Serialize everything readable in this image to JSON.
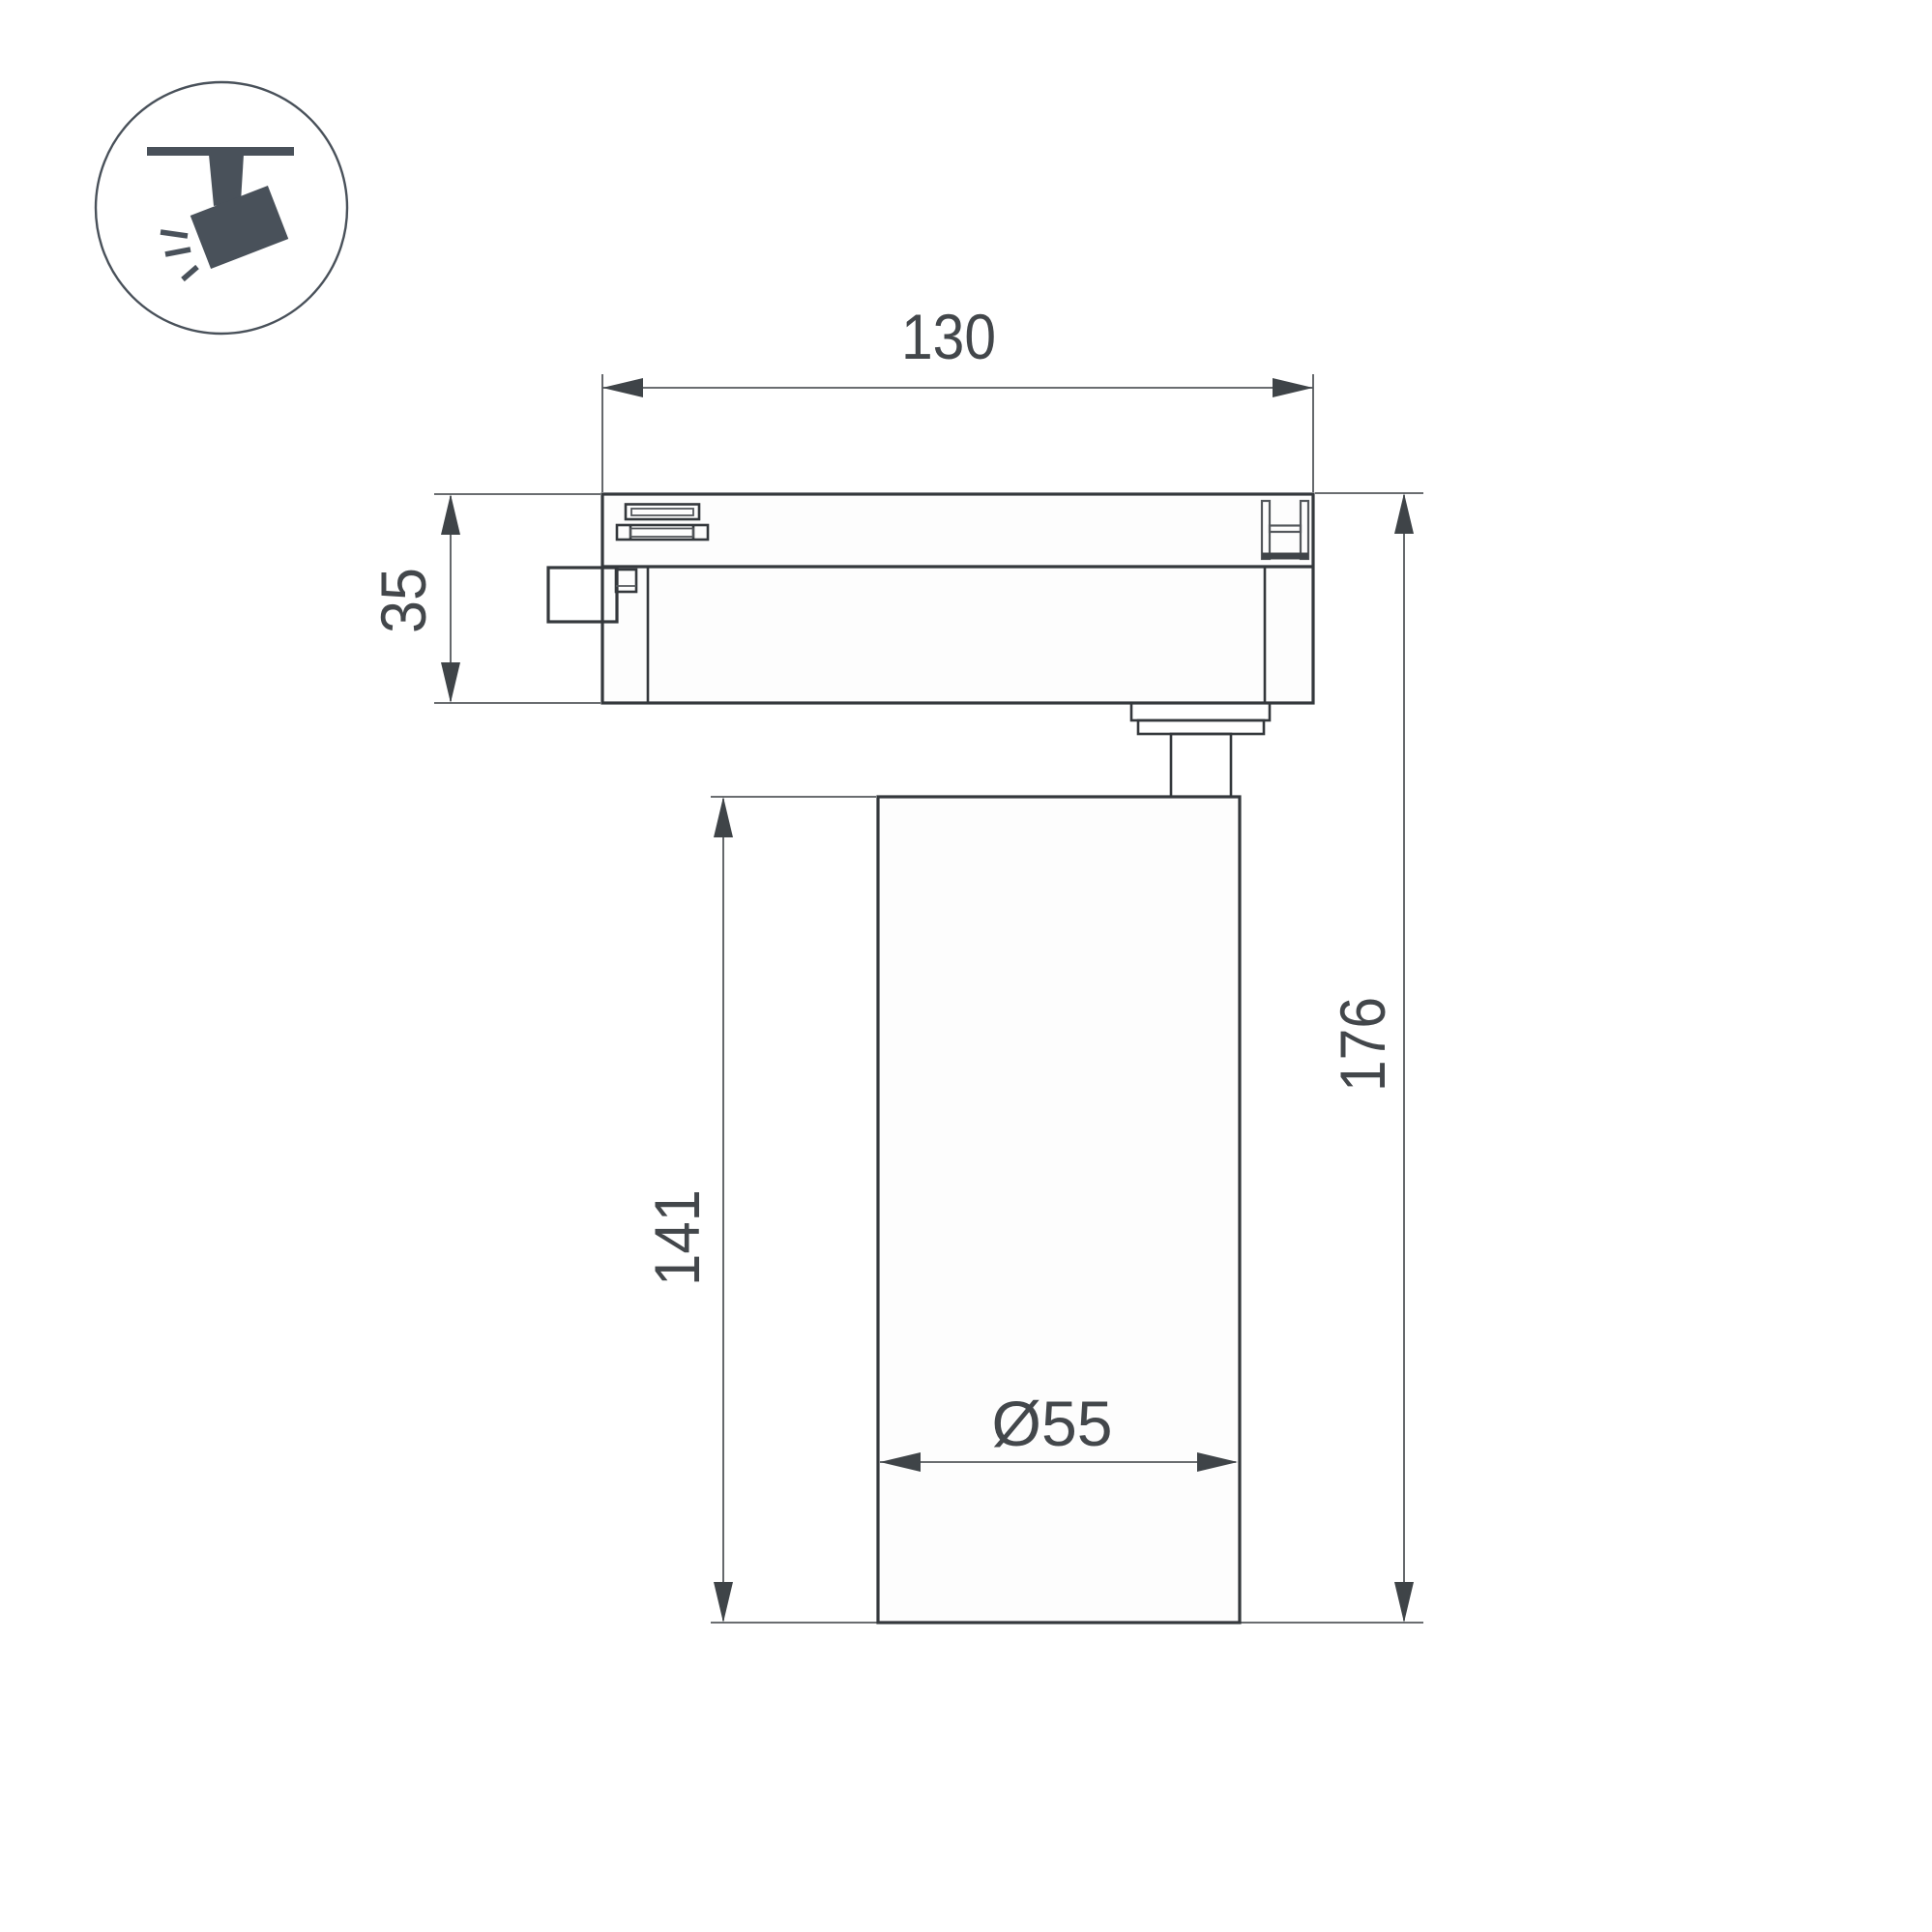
{
  "drawing": {
    "type": "technical-dimension-drawing",
    "subject": "track-mounted spotlight, side view",
    "icon": {
      "name": "track-spotlight-icon",
      "description": "spotlight hanging from ceiling track, tilted, with light rays"
    },
    "dimensions": {
      "track_width": "130",
      "adapter_height": "35",
      "body_height": "141",
      "total_height": "176",
      "body_diameter": "Ø55"
    },
    "colors": {
      "bg": "#ffffff",
      "line": "#34383c",
      "thin": "#54585c",
      "arrow": "#3f4448",
      "text": "#43474b",
      "icon": "#49515a"
    }
  }
}
